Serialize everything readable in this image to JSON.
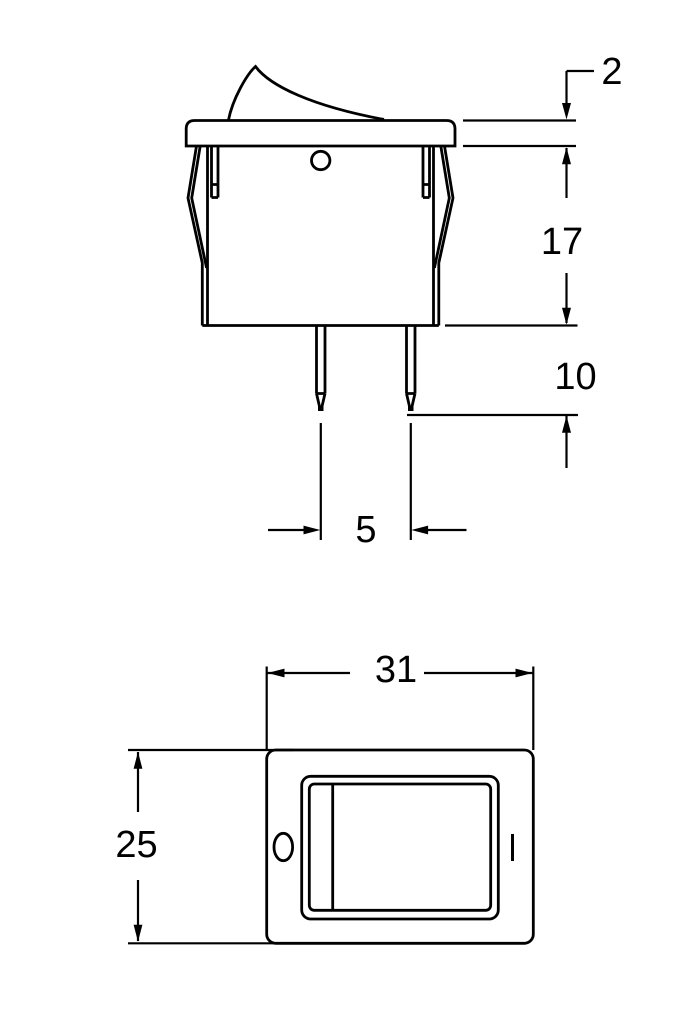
{
  "page": {
    "background": "#ffffff",
    "line_color": "#000000",
    "content": "rocker-switch-dimensional-drawing"
  },
  "side_view": {
    "dimensions": {
      "flange_thickness": "2",
      "housing_depth": "17",
      "terminal_length": "10",
      "terminal_spacing": "5"
    }
  },
  "front_view": {
    "dimensions": {
      "width": "31",
      "height": "25"
    },
    "markings": {
      "off_symbol": "O",
      "on_symbol": "|"
    }
  }
}
